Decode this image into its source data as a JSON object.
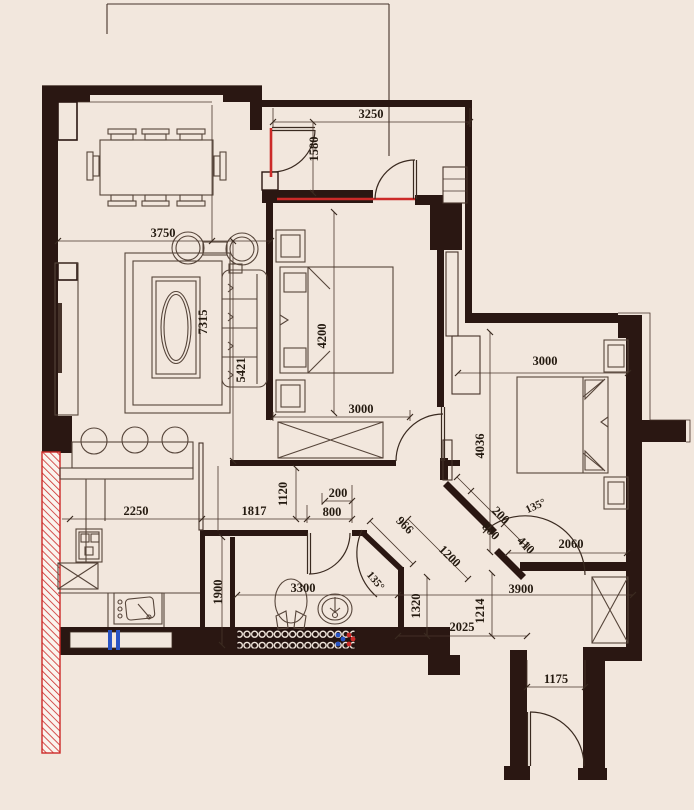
{
  "plan_title": "apartment-floor-plan",
  "colors": {
    "background": "#f2e7dd",
    "wall": "#2a1712",
    "line": "#46332a",
    "accent_red": "#cc2a28",
    "accent_blue": "#2853c4",
    "text": "#241a10"
  },
  "dims": {
    "d3250": "3250",
    "d1580": "1580",
    "d3750": "3750",
    "d7315": "7315",
    "d5421": "5421",
    "d4200": "4200",
    "d3000_bed1": "3000",
    "d2250": "2250",
    "d1817": "1817",
    "d1120": "1120",
    "d200_bath": "200",
    "d800_bath": "800",
    "d966": "966",
    "d135_bath": "135°",
    "d1900": "1900",
    "d3300": "3300",
    "d3000_bed2": "3000",
    "d4036": "4036",
    "d2060": "2060",
    "d200_bed2": "200",
    "d800_bed2": "800",
    "d410": "410",
    "d135_bed2": "135°",
    "d1200": "1200",
    "d1320": "1320",
    "d3900": "3900",
    "d1214": "1214",
    "d2025": "2025",
    "d1175": "1175"
  }
}
